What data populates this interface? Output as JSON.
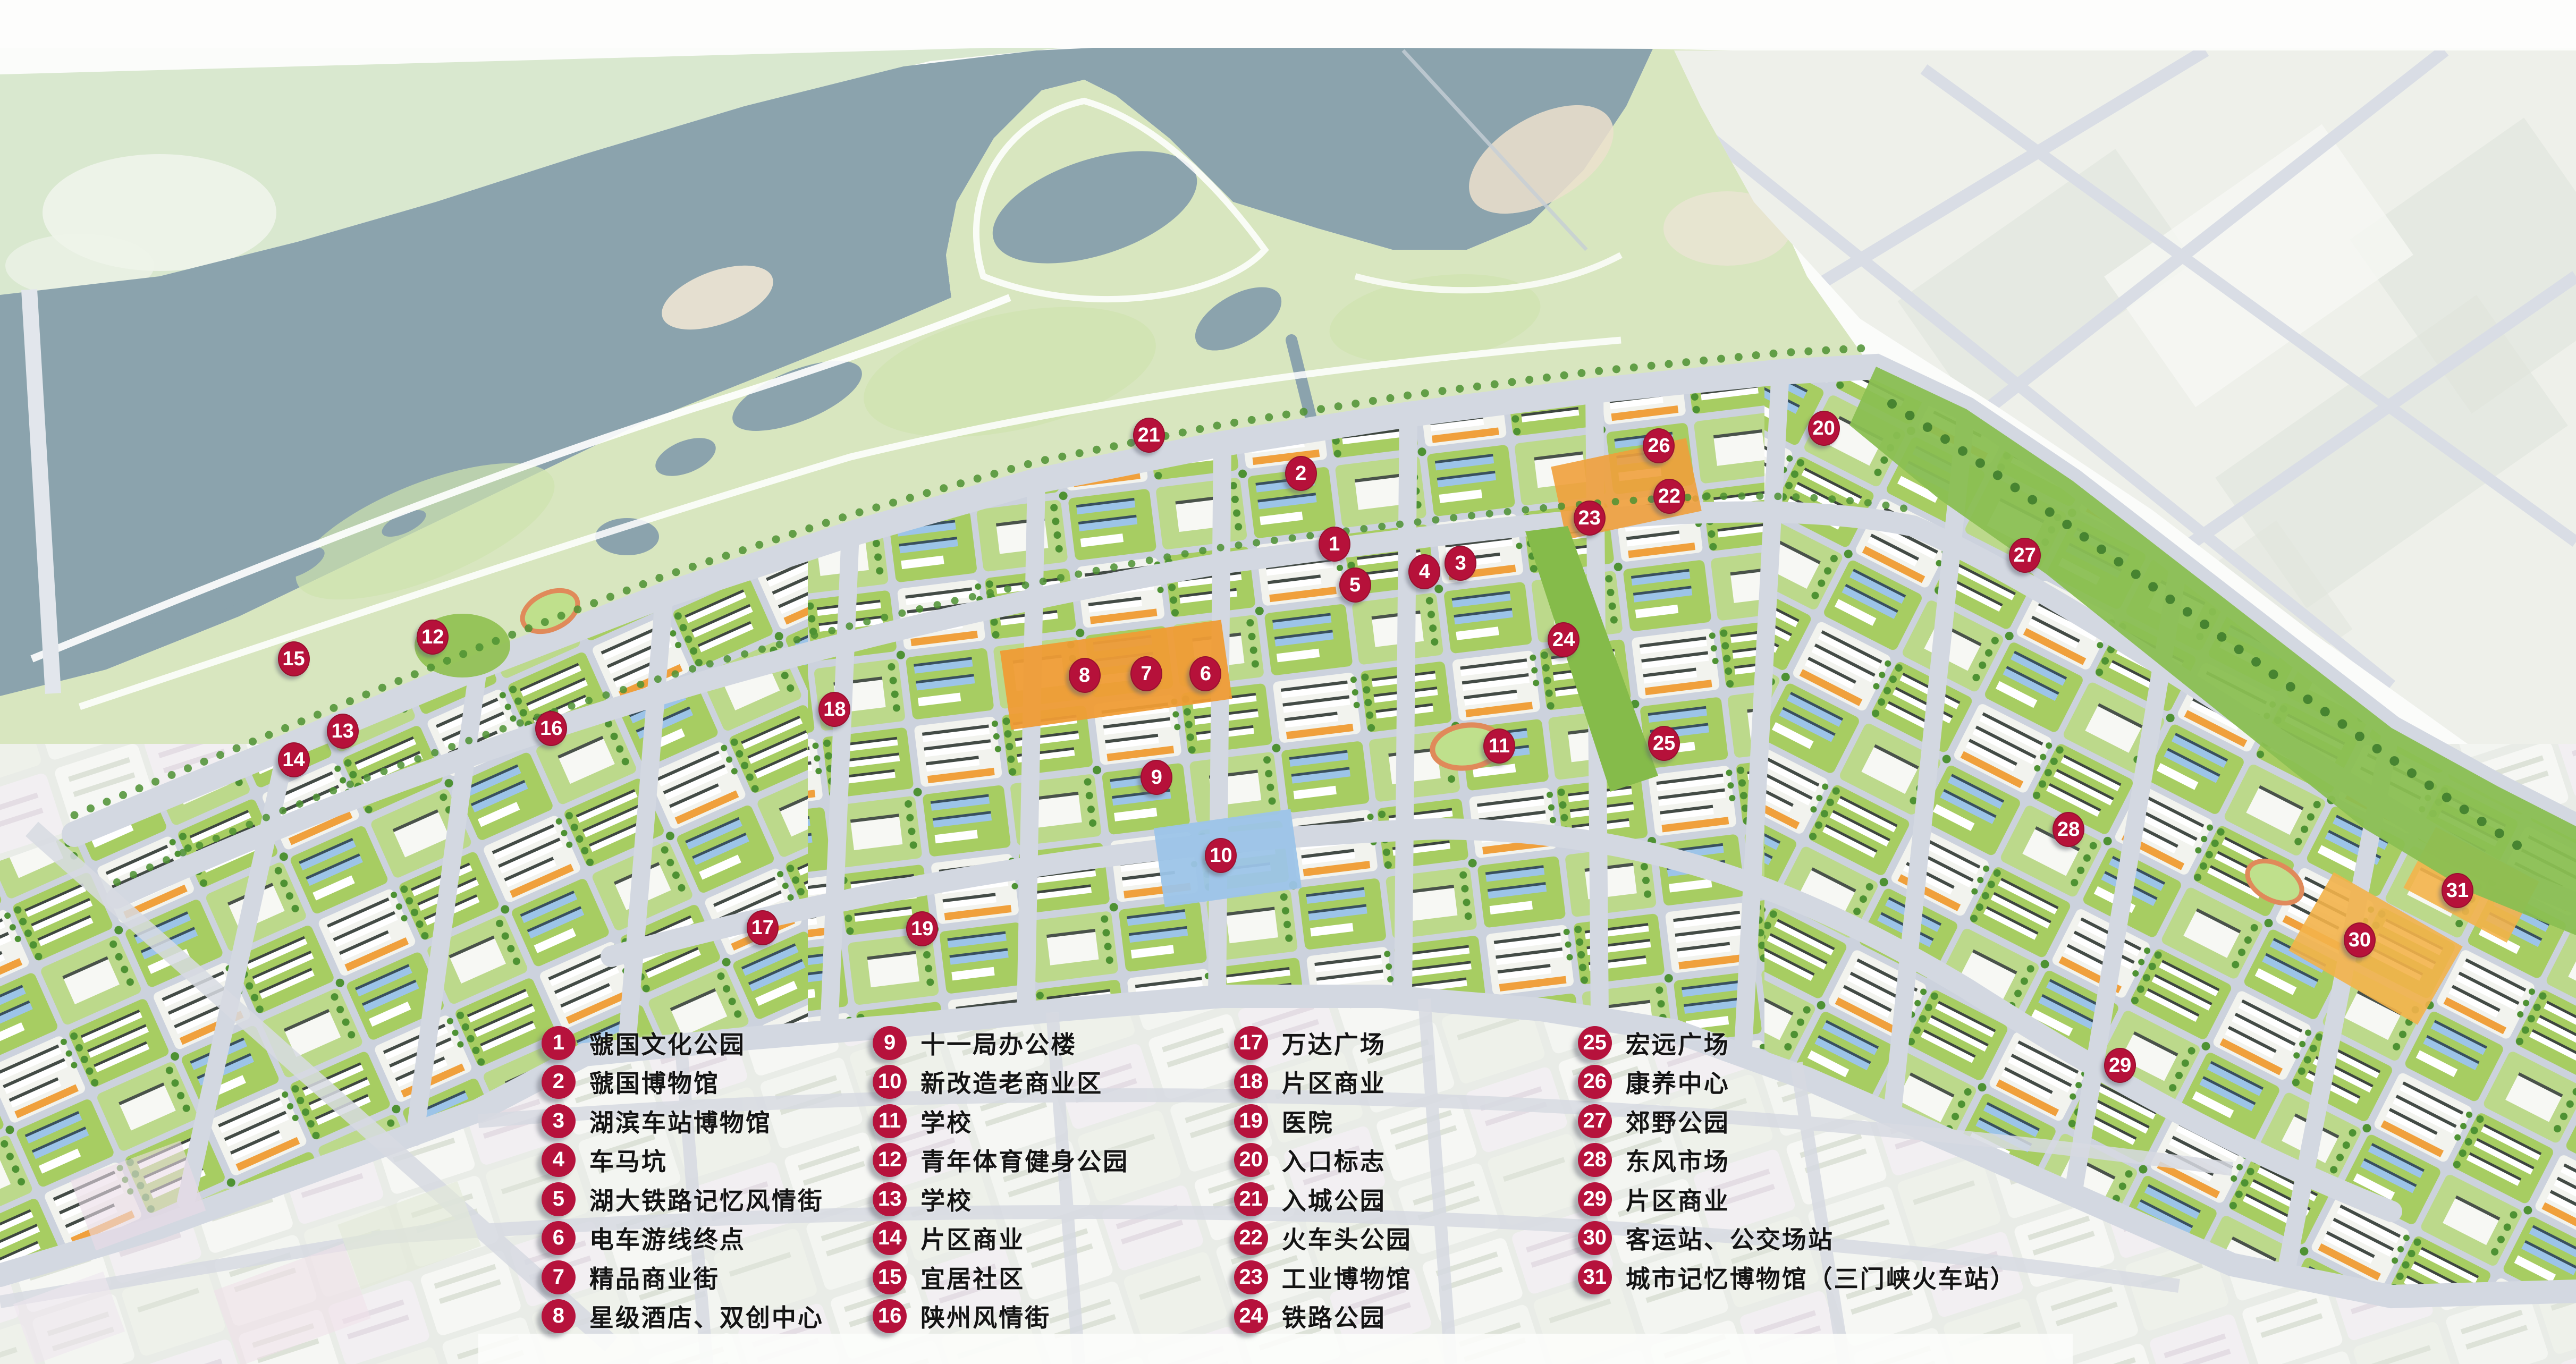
{
  "colors": {
    "marker": "#b6123c",
    "water": "#8ba3ad",
    "park": "#d8e6bf",
    "north_bank": "#d9e8cf",
    "road": "#d3d8e1",
    "city_base": "#ccd2dd",
    "lawn_green": "#a7cd62",
    "tree_green": "#4e9233",
    "commercial_orange": "#f0a03c",
    "blue_roof": "#9cc4e8",
    "faded_city": "#e9ece7"
  },
  "legend": {
    "columns": [
      {
        "x": 21.02,
        "y": 75.03,
        "items": [
          {
            "n": "1",
            "label": "虢国文化公园"
          },
          {
            "n": "2",
            "label": "虢国博物馆"
          },
          {
            "n": "3",
            "label": "湖滨车站博物馆"
          },
          {
            "n": "4",
            "label": "车马坑"
          },
          {
            "n": "5",
            "label": "湖大铁路记忆风情街"
          },
          {
            "n": "6",
            "label": "电车游线终点"
          },
          {
            "n": "7",
            "label": "精品商业街"
          },
          {
            "n": "8",
            "label": "星级酒店、双创中心"
          }
        ]
      },
      {
        "x": 33.88,
        "y": 75.03,
        "items": [
          {
            "n": "9",
            "label": "十一局办公楼"
          },
          {
            "n": "10",
            "label": "新改造老商业区"
          },
          {
            "n": "11",
            "label": "学校"
          },
          {
            "n": "12",
            "label": "青年体育健身公园"
          },
          {
            "n": "13",
            "label": "学校"
          },
          {
            "n": "14",
            "label": "片区商业"
          },
          {
            "n": "15",
            "label": "宜居社区"
          },
          {
            "n": "16",
            "label": "陕州风情街"
          }
        ]
      },
      {
        "x": 47.9,
        "y": 75.03,
        "items": [
          {
            "n": "17",
            "label": "万达广场"
          },
          {
            "n": "18",
            "label": "片区商业"
          },
          {
            "n": "19",
            "label": "医院"
          },
          {
            "n": "20",
            "label": "入口标志"
          },
          {
            "n": "21",
            "label": "入城公园"
          },
          {
            "n": "22",
            "label": "火车头公园"
          },
          {
            "n": "23",
            "label": "工业博物馆"
          },
          {
            "n": "24",
            "label": "铁路公园"
          }
        ]
      },
      {
        "x": 61.25,
        "y": 75.03,
        "items": [
          {
            "n": "25",
            "label": "宏远广场"
          },
          {
            "n": "26",
            "label": "康养中心"
          },
          {
            "n": "27",
            "label": "郊野公园"
          },
          {
            "n": "28",
            "label": "东风市场"
          },
          {
            "n": "29",
            "label": "片区商业"
          },
          {
            "n": "30",
            "label": "客运站、公交场站"
          },
          {
            "n": "31",
            "label": "城市记忆博物馆（三门峡火车站）"
          }
        ]
      }
    ]
  },
  "map": {
    "markers": [
      {
        "n": "1",
        "x": 51.8,
        "y": 39.9
      },
      {
        "n": "2",
        "x": 50.5,
        "y": 34.7
      },
      {
        "n": "3",
        "x": 56.7,
        "y": 41.3
      },
      {
        "n": "4",
        "x": 55.3,
        "y": 41.9
      },
      {
        "n": "5",
        "x": 52.6,
        "y": 42.9
      },
      {
        "n": "6",
        "x": 46.8,
        "y": 49.4
      },
      {
        "n": "7",
        "x": 44.5,
        "y": 49.4
      },
      {
        "n": "8",
        "x": 42.1,
        "y": 49.5
      },
      {
        "n": "9",
        "x": 44.9,
        "y": 57.0
      },
      {
        "n": "10",
        "x": 47.4,
        "y": 62.7
      },
      {
        "n": "11",
        "x": 58.2,
        "y": 54.7
      },
      {
        "n": "12",
        "x": 16.8,
        "y": 46.7
      },
      {
        "n": "13",
        "x": 13.3,
        "y": 53.6
      },
      {
        "n": "14",
        "x": 11.4,
        "y": 55.7
      },
      {
        "n": "15",
        "x": 11.4,
        "y": 48.3
      },
      {
        "n": "16",
        "x": 21.4,
        "y": 53.4
      },
      {
        "n": "17",
        "x": 29.6,
        "y": 68.0
      },
      {
        "n": "18",
        "x": 32.4,
        "y": 52.0
      },
      {
        "n": "19",
        "x": 35.8,
        "y": 68.1
      },
      {
        "n": "20",
        "x": 70.8,
        "y": 31.4
      },
      {
        "n": "21",
        "x": 44.6,
        "y": 31.9
      },
      {
        "n": "22",
        "x": 64.8,
        "y": 36.4
      },
      {
        "n": "23",
        "x": 61.7,
        "y": 38.0
      },
      {
        "n": "24",
        "x": 60.7,
        "y": 46.9
      },
      {
        "n": "25",
        "x": 64.6,
        "y": 54.5
      },
      {
        "n": "26",
        "x": 64.4,
        "y": 32.7
      },
      {
        "n": "27",
        "x": 78.6,
        "y": 40.7
      },
      {
        "n": "28",
        "x": 80.3,
        "y": 60.8
      },
      {
        "n": "29",
        "x": 82.3,
        "y": 78.1
      },
      {
        "n": "30",
        "x": 91.6,
        "y": 68.9
      },
      {
        "n": "31",
        "x": 95.4,
        "y": 65.3
      }
    ]
  }
}
